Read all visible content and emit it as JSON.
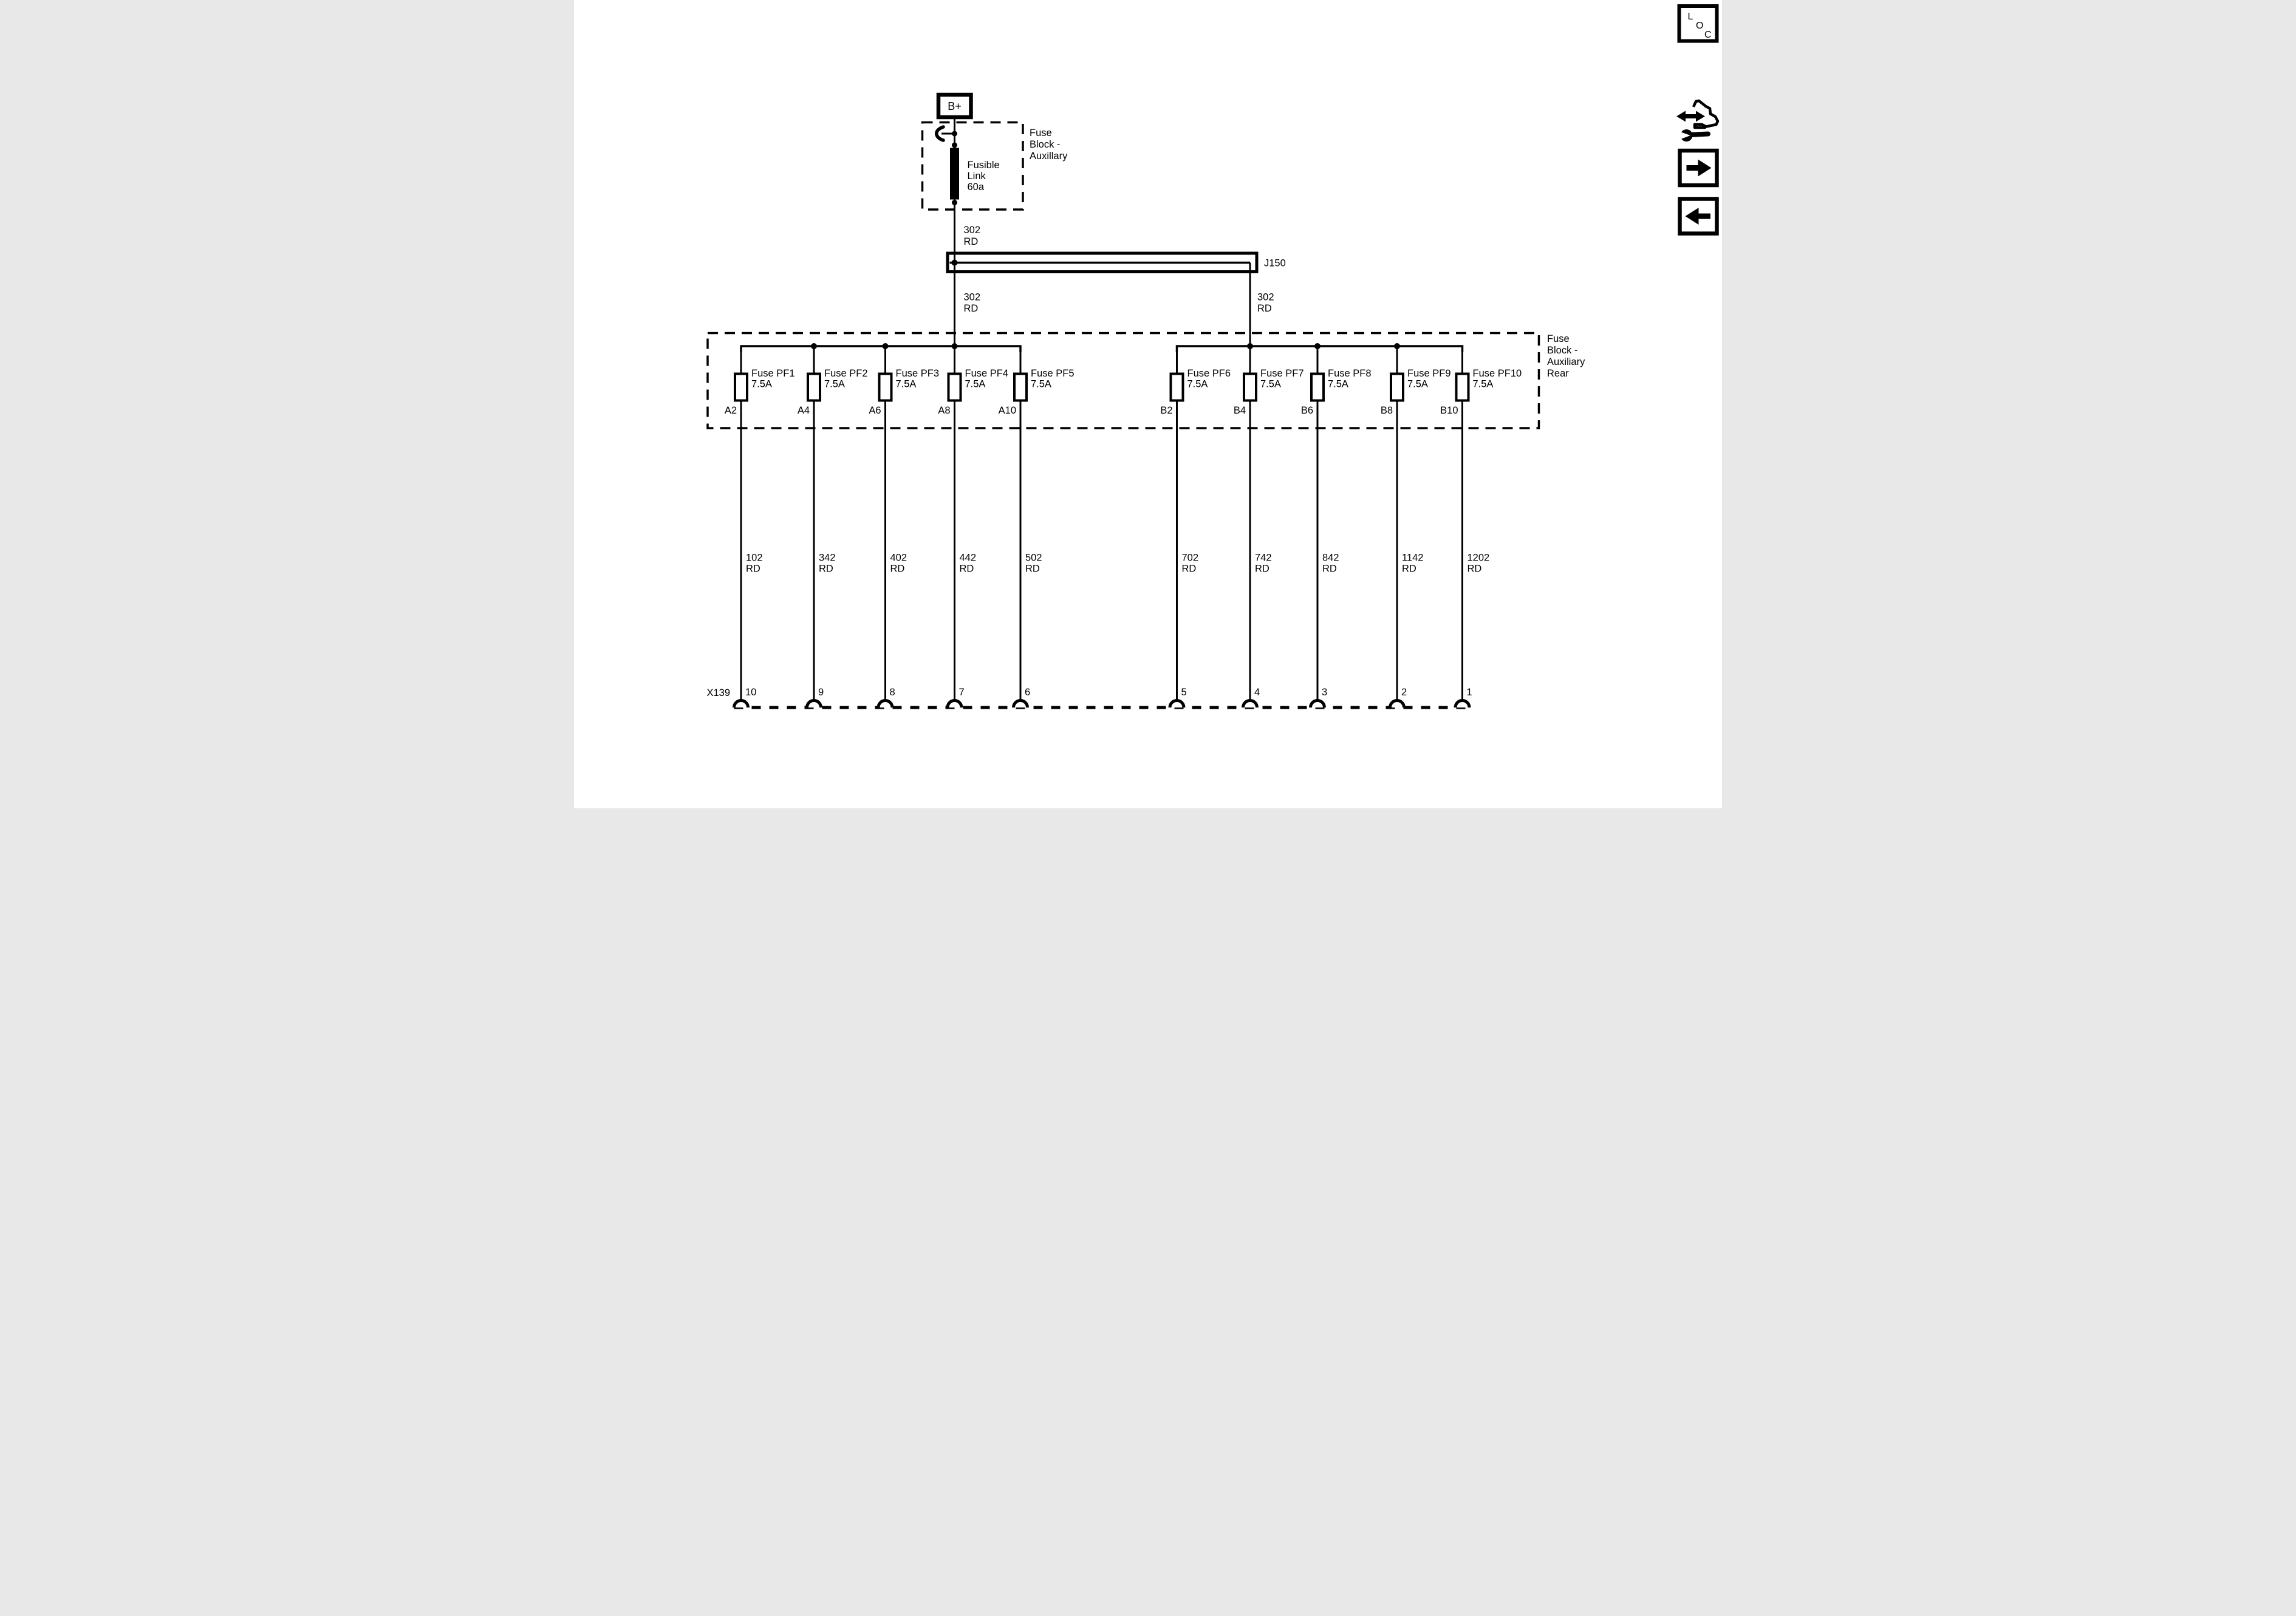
{
  "diagram": {
    "power_terminal": "B+",
    "upper_block": {
      "label_lines": [
        "Fuse",
        "Block -",
        "Auxillary"
      ],
      "fusible_link_lines": [
        "Fusible",
        "Link",
        "60a"
      ]
    },
    "feed_wire": {
      "circuit": "302",
      "color": "RD"
    },
    "junction_label": "J150",
    "left_feed": {
      "circuit": "302",
      "color": "RD"
    },
    "right_feed": {
      "circuit": "302",
      "color": "RD"
    },
    "fuse_block": {
      "label_lines": [
        "Fuse",
        "Block -",
        "Auxiliary",
        "Rear"
      ],
      "fuses": [
        {
          "name": "Fuse PF1",
          "rating": "7.5A",
          "pin": "A2",
          "circuit": "102",
          "color": "RD",
          "connector_pin": "10"
        },
        {
          "name": "Fuse PF2",
          "rating": "7.5A",
          "pin": "A4",
          "circuit": "342",
          "color": "RD",
          "connector_pin": "9"
        },
        {
          "name": "Fuse PF3",
          "rating": "7.5A",
          "pin": "A6",
          "circuit": "402",
          "color": "RD",
          "connector_pin": "8"
        },
        {
          "name": "Fuse PF4",
          "rating": "7.5A",
          "pin": "A8",
          "circuit": "442",
          "color": "RD",
          "connector_pin": "7"
        },
        {
          "name": "Fuse PF5",
          "rating": "7.5A",
          "pin": "A10",
          "circuit": "502",
          "color": "RD",
          "connector_pin": "6"
        },
        {
          "name": "Fuse PF6",
          "rating": "7.5A",
          "pin": "B2",
          "circuit": "702",
          "color": "RD",
          "connector_pin": "5"
        },
        {
          "name": "Fuse PF7",
          "rating": "7.5A",
          "pin": "B4",
          "circuit": "742",
          "color": "RD",
          "connector_pin": "4"
        },
        {
          "name": "Fuse PF8",
          "rating": "7.5A",
          "pin": "B6",
          "circuit": "842",
          "color": "RD",
          "connector_pin": "3"
        },
        {
          "name": "Fuse PF9",
          "rating": "7.5A",
          "pin": "B8",
          "circuit": "1142",
          "color": "RD",
          "connector_pin": "2"
        },
        {
          "name": "Fuse PF10",
          "rating": "7.5A",
          "pin": "B10",
          "circuit": "1202",
          "color": "RD",
          "connector_pin": "1"
        }
      ]
    },
    "connector_label": "X139"
  },
  "nav": {
    "loc_letters": [
      "L",
      "O",
      "C"
    ]
  },
  "colors": {
    "ink": "#000000",
    "paper": "#ffffff"
  }
}
